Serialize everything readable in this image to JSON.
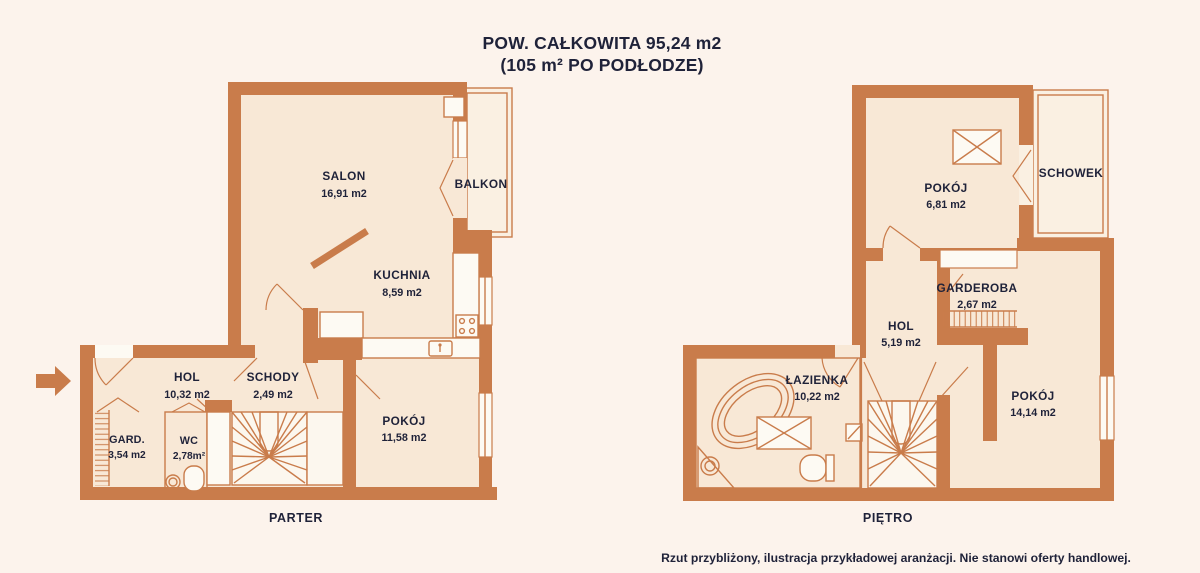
{
  "title": {
    "line1": "POW. CAŁKOWITA 95,24 m2",
    "line2": "(105 m² PO PODŁODZE)"
  },
  "disclaimer": "Rzut przybliżony, ilustracja przykładowej aranżacji. Nie stanowi oferty handlowej.",
  "floors": {
    "parter": {
      "label": "PARTER",
      "rooms": [
        {
          "name": "SALON",
          "area": "16,91 m2"
        },
        {
          "name": "BALKON"
        },
        {
          "name": "KUCHNIA",
          "area": "8,59 m2"
        },
        {
          "name": "HOL",
          "area": "10,32 m2"
        },
        {
          "name": "SCHODY",
          "area": "2,49 m2"
        },
        {
          "name": "POKÓJ",
          "area": "11,58 m2"
        },
        {
          "name": "GARD.",
          "area": "3,54 m2"
        },
        {
          "name": "WC",
          "area": "2,78m²"
        }
      ]
    },
    "pietro": {
      "label": "PIĘTRO",
      "rooms": [
        {
          "name": "POKÓJ",
          "area": "6,81 m2"
        },
        {
          "name": "SCHOWEK"
        },
        {
          "name": "GARDEROBA",
          "area": "2,67 m2"
        },
        {
          "name": "HOL",
          "area": "5,19 m2"
        },
        {
          "name": "ŁAZIENKA",
          "area": "10,22 m2"
        },
        {
          "name": "POKÓJ",
          "area": "14,14 m2"
        }
      ]
    }
  },
  "colors": {
    "wall": "#c97c4b",
    "floor": "#f8e8d6",
    "floor_light": "#faf0e2",
    "wet_room": "#a8c3e5",
    "background": "#fcf3ec",
    "text": "#1f2239"
  }
}
